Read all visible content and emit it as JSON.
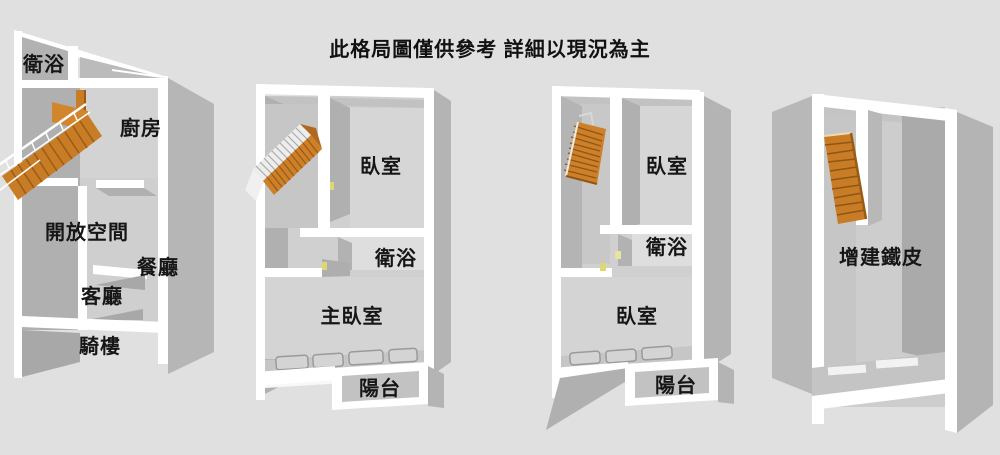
{
  "title": "此格局圖僅供參考 詳細以現況為主",
  "rooms": {
    "u1_bath": "衛浴",
    "u1_kitchen": "廚房",
    "u1_open": "開放空間",
    "u1_dining": "餐廳",
    "u1_living": "客廳",
    "u1_arcade": "騎樓",
    "u2_bedroom": "臥室",
    "u2_bath": "衛浴",
    "u2_master": "主臥室",
    "u2_balcony": "陽台",
    "u3_bedroom_top": "臥室",
    "u3_bath": "衛浴",
    "u3_bedroom_bottom": "臥室",
    "u3_balcony": "陽台",
    "u4_addition": "增建鐵皮"
  },
  "colors": {
    "background": "#e0e0e0",
    "wall_white": "#ffffff",
    "wall_gray_outer": "#b4b4b4",
    "wall_gray_inner": "#b0b0b0",
    "floor_light": "#d2d2d2",
    "stair_orange": "#cd8029",
    "stair_dark": "#9a5c14",
    "door_marker_yellow": "#ded874",
    "text": "#161616"
  }
}
